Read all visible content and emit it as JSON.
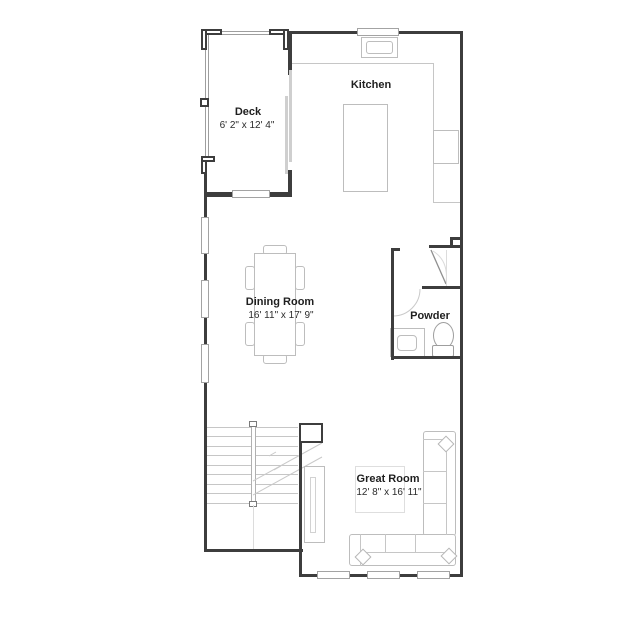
{
  "meta": {
    "type": "floor-plan",
    "level_shown": "main level"
  },
  "colors": {
    "wall": "#3d3d3d",
    "furniture_line": "#bdbdbd",
    "light_line": "#c6c6c6",
    "text": "#1f1f1f",
    "background": "#ffffff"
  },
  "rooms": {
    "deck": {
      "name": "Deck",
      "dims": "6' 2\"  x 12' 4\""
    },
    "kitchen": {
      "name": "Kitchen"
    },
    "dining": {
      "name": "Dining Room",
      "dims": "16' 11\" x 17' 9\""
    },
    "powder": {
      "name": "Powder"
    },
    "great": {
      "name": "Great Room",
      "dims": "12' 8\" x 16' 11\""
    }
  },
  "fixtures": [
    "kitchen-island",
    "kitchen-sink",
    "stove",
    "dining-table",
    "dining-chairs",
    "powder-vanity",
    "toilet",
    "sectional-sofa",
    "throw-pillows",
    "tv-console",
    "staircase",
    "sliding-glass-door",
    "windows"
  ]
}
